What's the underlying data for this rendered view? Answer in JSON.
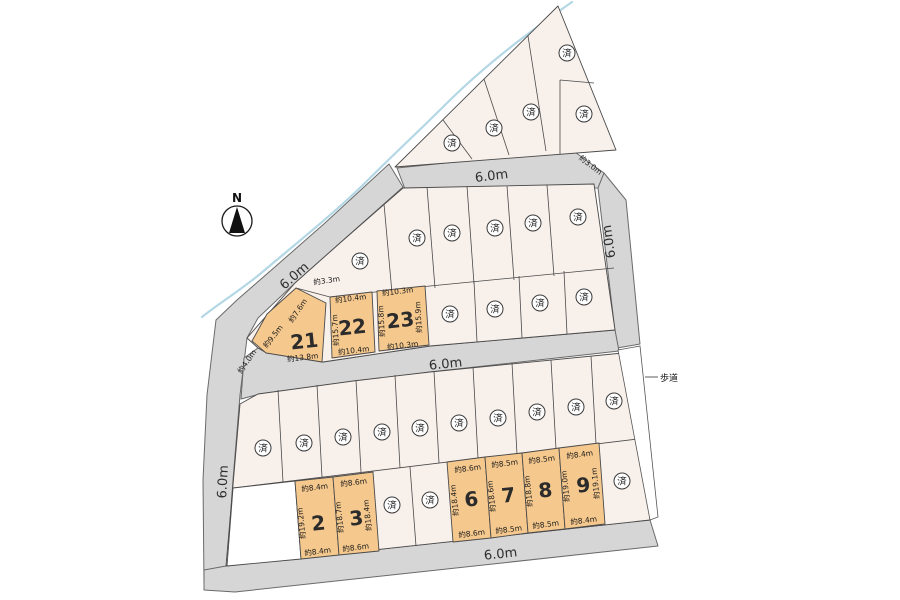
{
  "compass": {
    "label": "N"
  },
  "marks": {
    "sold": "済"
  },
  "sidewalk": {
    "label": "歩道"
  },
  "roads": {
    "diagonal": {
      "label": "6.0m"
    },
    "top": {
      "label": "6.0m"
    },
    "branch": {
      "label": "約3.0m"
    },
    "right": {
      "label": "6.0m"
    },
    "left": {
      "label": "6.0m"
    },
    "middle": {
      "label": "6.0m"
    },
    "bottom": {
      "label": "6.0m"
    }
  },
  "boundary_dims": {
    "d33": "約3.3m",
    "d40": "約4.0m"
  },
  "plots": [
    {
      "no": "21",
      "top": "約7.6m",
      "left": "約9.5m",
      "bottom": "約13.8m"
    },
    {
      "no": "22",
      "top": "約10.4m",
      "left": "約15.7m",
      "bottom": "約10.4m"
    },
    {
      "no": "23",
      "top": "約10.3m",
      "left": "約15.8m",
      "right": "約15.9m",
      "bottom": "約10.3m"
    },
    {
      "no": "2",
      "top": "約8.4m",
      "left": "約19.2m",
      "bottom": "約8.4m"
    },
    {
      "no": "3",
      "top": "約8.6m",
      "left": "約18.7m",
      "right": "約18.4m",
      "bottom": "約8.6m"
    },
    {
      "no": "6",
      "top": "約8.6m",
      "left": "約18.4m",
      "bottom": "約8.6m"
    },
    {
      "no": "7",
      "top": "約8.5m",
      "left": "約18.6m",
      "bottom": "約8.5m"
    },
    {
      "no": "8",
      "top": "約8.5m",
      "left": "約18.8m",
      "bottom": "約8.5m"
    },
    {
      "no": "9",
      "top": "約8.4m",
      "left": "約19.0m",
      "right": "約19.1m",
      "bottom": "約8.4m"
    }
  ],
  "colors": {
    "available_lot": "#f5c88d",
    "sold_lot": "#f8f0eb",
    "empty_lot": "#ffffff",
    "road": "#d6d6d6",
    "stream": "#b3d7e5"
  }
}
